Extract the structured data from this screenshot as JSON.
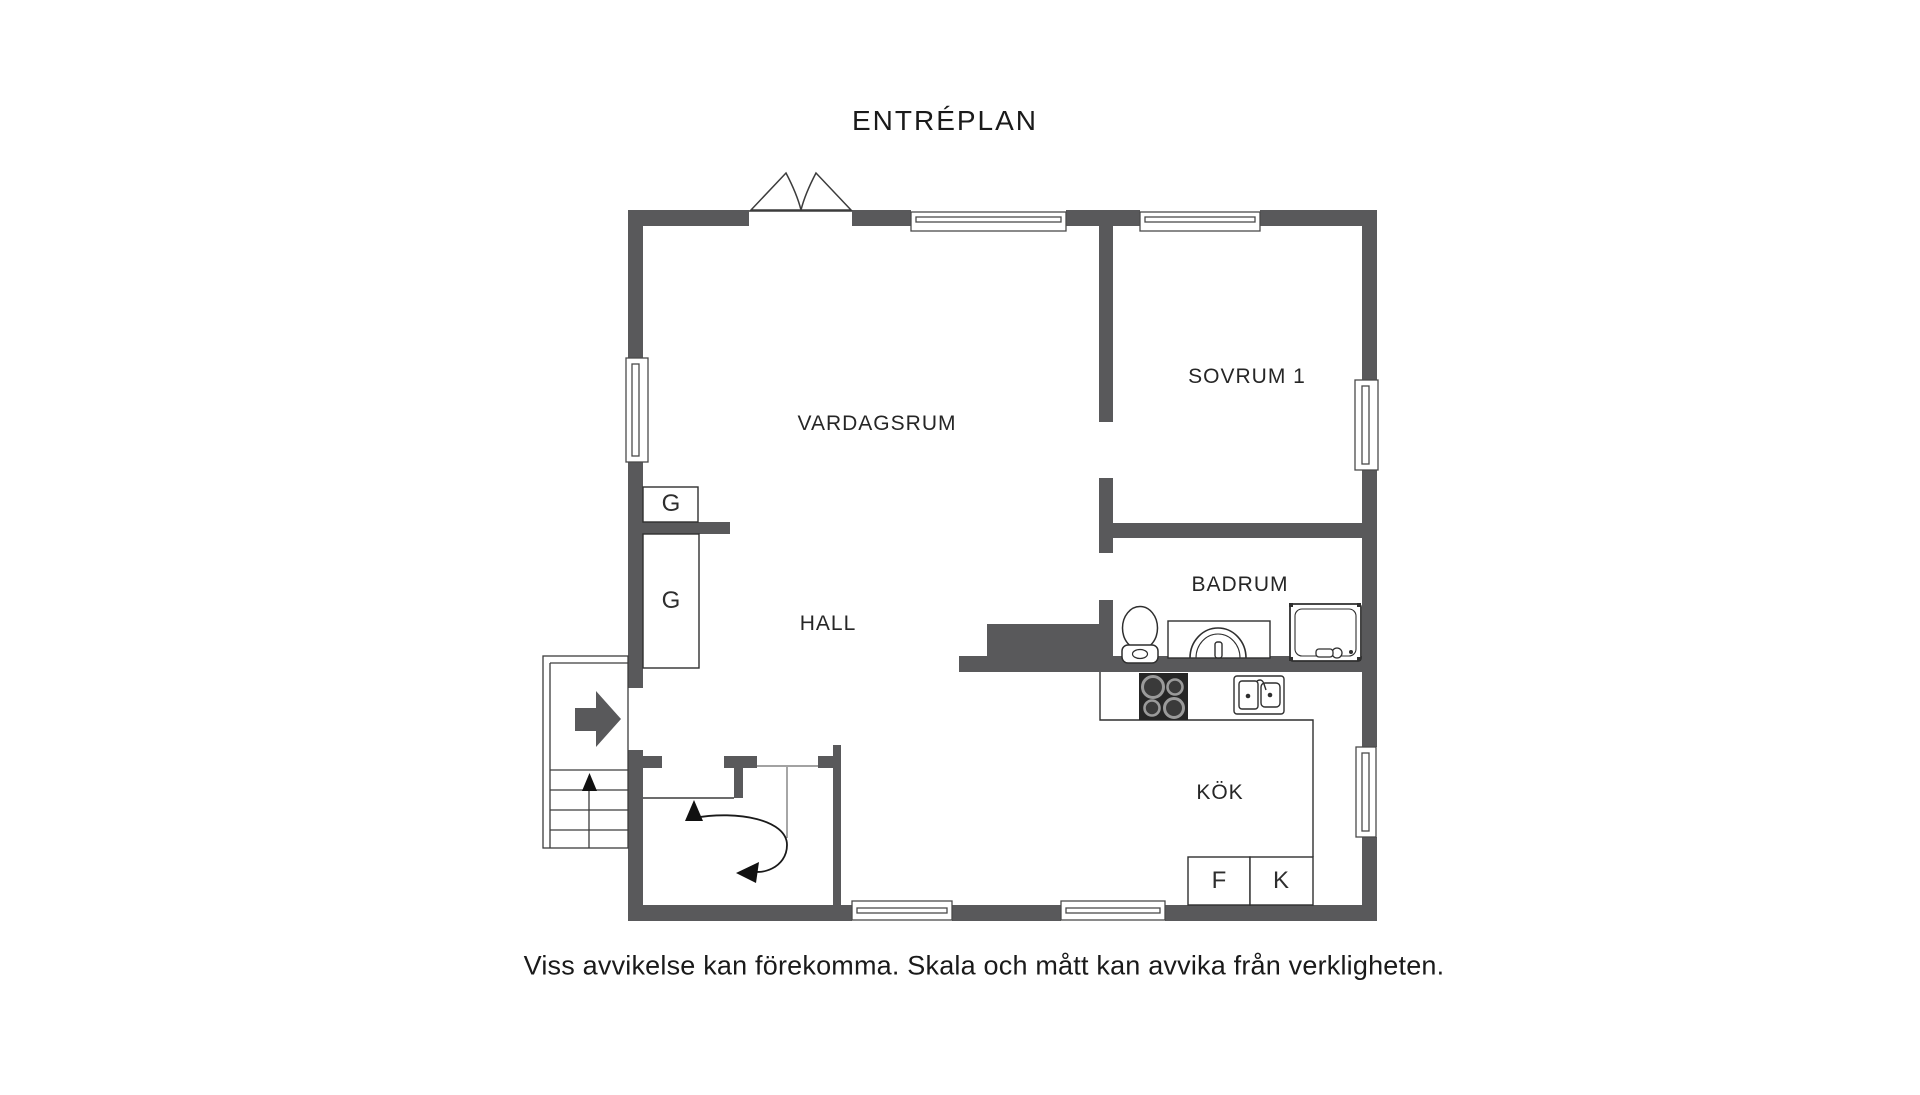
{
  "title": "ENTRÉPLAN",
  "disclaimer": "Viss avvikelse kan förekomma. Skala och mått kan avvika från verkligheten.",
  "rooms": {
    "vardagsrum": "VARDAGSRUM",
    "sovrum1": "SOVRUM 1",
    "badrum": "BADRUM",
    "hall": "HALL",
    "kok": "KÖK"
  },
  "closets": {
    "g1": "G",
    "g2": "G"
  },
  "appliances": {
    "fridge": "F",
    "freezer": "K"
  },
  "colors": {
    "wall": "#59595B",
    "outline": "#3C3C3C",
    "fixture_line": "#2F2F2F",
    "text": "#1C1C1C",
    "background": "#FFFFFF"
  },
  "icons": [
    "entrance-double-door-icon",
    "window-icon",
    "staircase-icon",
    "entry-direction-arrow-icon",
    "stair-curve-arrow-icon",
    "toilet-icon",
    "bathroom-sink-icon",
    "shower-icon",
    "stove-icon",
    "kitchen-sink-icon",
    "chimney-block"
  ]
}
